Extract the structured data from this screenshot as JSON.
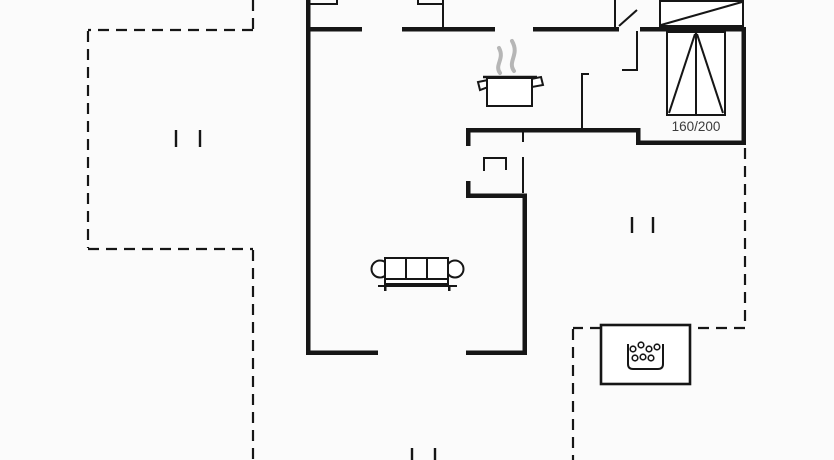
{
  "floorplan": {
    "bed_label": "160/200",
    "colors": {
      "background": "#fbfbfb",
      "line": "#161616",
      "steam": "#b6b6b6",
      "label": "#3c3c3c"
    },
    "icons": {
      "pot": "cooking-pot-icon",
      "steam": "steam-icon",
      "bed": "double-bed-icon",
      "wardrobe": "wardrobe-icon",
      "sofa": "sofa-icon",
      "table": "side-table-icon",
      "whirlpool": "whirlpool-tub-icon"
    }
  }
}
